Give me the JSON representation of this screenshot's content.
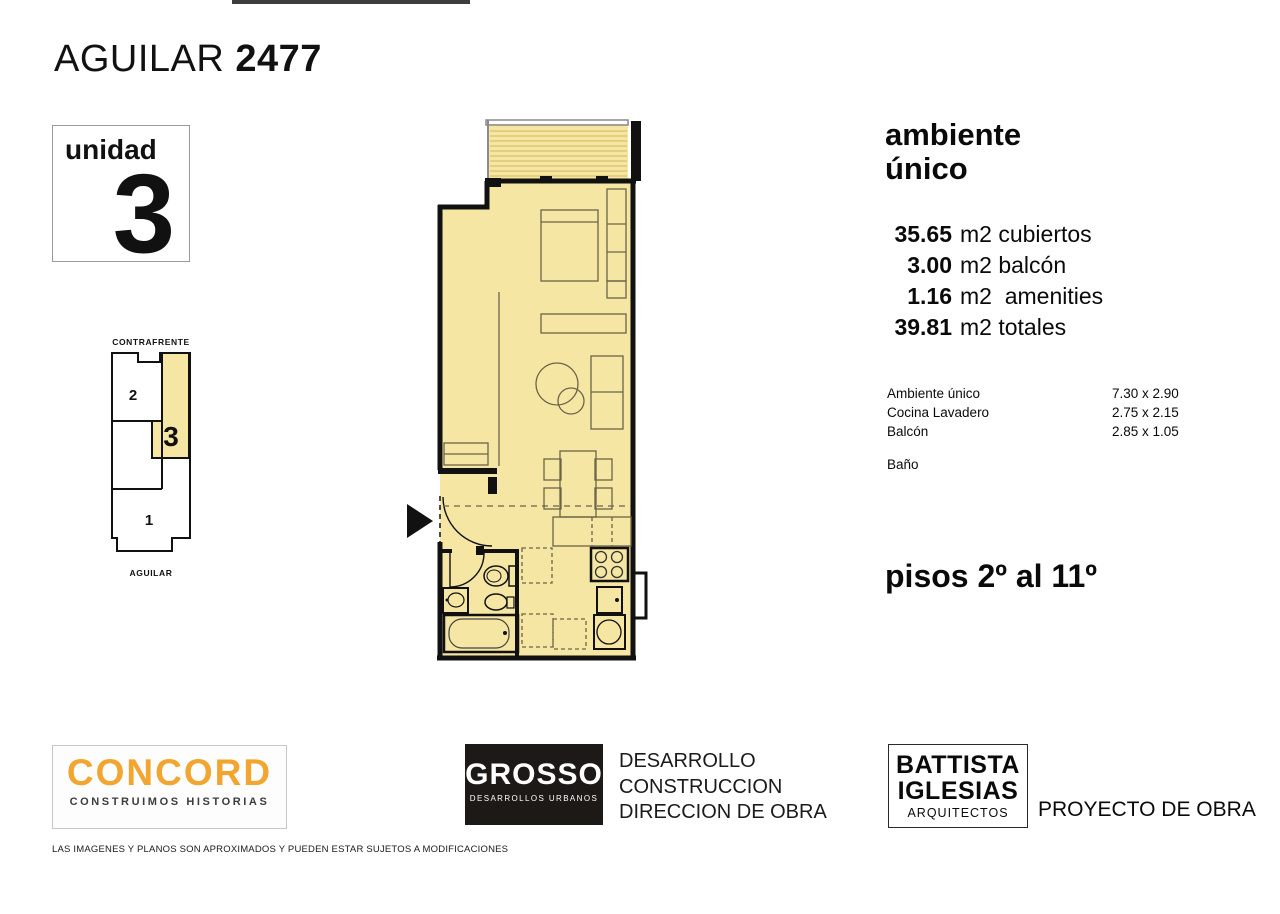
{
  "page": {
    "title_regular": "AGUILAR",
    "title_bold": "2477"
  },
  "unit_badge": {
    "label": "unidad",
    "number": "3"
  },
  "key_plan": {
    "top_label": "CONTRAFRENTE",
    "bottom_label": "AGUILAR",
    "unit1": "1",
    "unit2": "2",
    "unit3": "3"
  },
  "details": {
    "type_line1": "ambiente",
    "type_line2": "único",
    "areas": [
      {
        "value": "35.65",
        "label": "m2 cubiertos"
      },
      {
        "value": "3.00",
        "label": "m2 balcón"
      },
      {
        "value": "1.16",
        "label": "m2  amenities"
      },
      {
        "value": "39.81",
        "label": "m2 totales"
      }
    ],
    "rooms": [
      {
        "name": "Ambiente único",
        "dims": "7.30 x 2.90"
      },
      {
        "name": "Cocina Lavadero",
        "dims": "2.75 x 2.15"
      },
      {
        "name": "Balcón",
        "dims": "2.85 x 1.05"
      }
    ],
    "extra_room": "Baño",
    "floors": "pisos 2º al 11º"
  },
  "footer": {
    "concord": {
      "name": "CONCORD",
      "tagline": "CONSTRUIMOS HISTORIAS",
      "brand_color": "#F2A52F"
    },
    "grosso": {
      "name": "GROSSO",
      "subtitle": "DESARROLLOS URBANOS",
      "services": [
        "DESARROLLO",
        "CONSTRUCCION",
        "DIRECCION DE OBRA"
      ]
    },
    "battista": {
      "name_line1": "BATTISTA",
      "name_line2": "IGLESIAS",
      "subtitle": "ARQUITECTOS",
      "role": "PROYECTO DE OBRA"
    },
    "disclaimer": "LAS IMAGENES Y PLANOS SON APROXIMADOS Y PUEDEN ESTAR SUJETOS A MODIFICACIONES"
  },
  "colors": {
    "plan_fill": "#F5E6A3",
    "wall": "#111111",
    "hatch": "#D9C06A"
  }
}
